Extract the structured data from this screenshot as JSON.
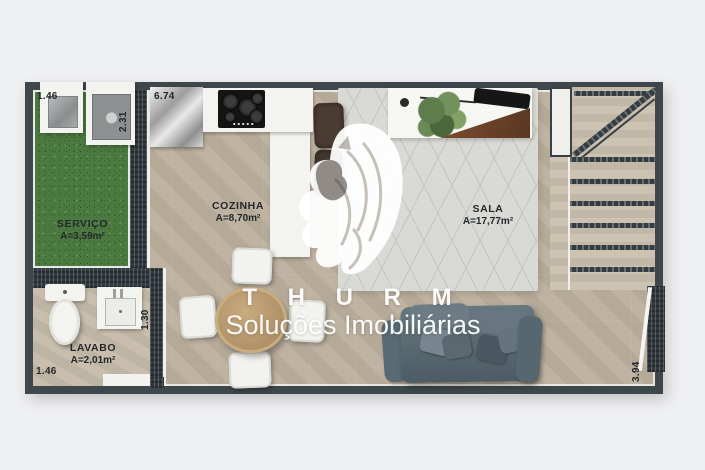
{
  "brand": {
    "name": "T H U R M",
    "tagline": "Soluções Imobiliárias",
    "logo": "lion-head-watermark"
  },
  "rooms": {
    "servico": {
      "name": "SERVIÇO",
      "area": "A=3,59m²"
    },
    "cozinha": {
      "name": "COZINHA",
      "area": "A=8,70m²"
    },
    "sala": {
      "name": "SALA",
      "area": "A=17,77m²"
    },
    "lavabo": {
      "name": "LAVABO",
      "area": "A=2,01m²"
    }
  },
  "measurements": {
    "service_width": "1.46",
    "service_depth": "2.31",
    "kitchen_width": "6.74",
    "lavabo_depth": "1.30",
    "lavabo_width": "1.46",
    "living_depth": "3.94"
  },
  "fixtures": [
    "laundry-tank",
    "washing-machine",
    "stainless-counter",
    "cooktop",
    "kitchen-peninsula",
    "bar-stool",
    "tv-console",
    "plant",
    "tv-soundbar",
    "area-rug",
    "staircase",
    "sofa",
    "dining-table",
    "dining-chair",
    "toilet",
    "bathroom-sink",
    "entry-door",
    "side-door"
  ],
  "colors": {
    "background": "#eff0f2",
    "wall": "#3e474c",
    "floor": "#bcb09e",
    "grass": "#4c7841",
    "rug": "#d9d9d5",
    "sofa": "#5b6b74",
    "table_wood": "#b3946a",
    "watermark": "#ffffff"
  }
}
